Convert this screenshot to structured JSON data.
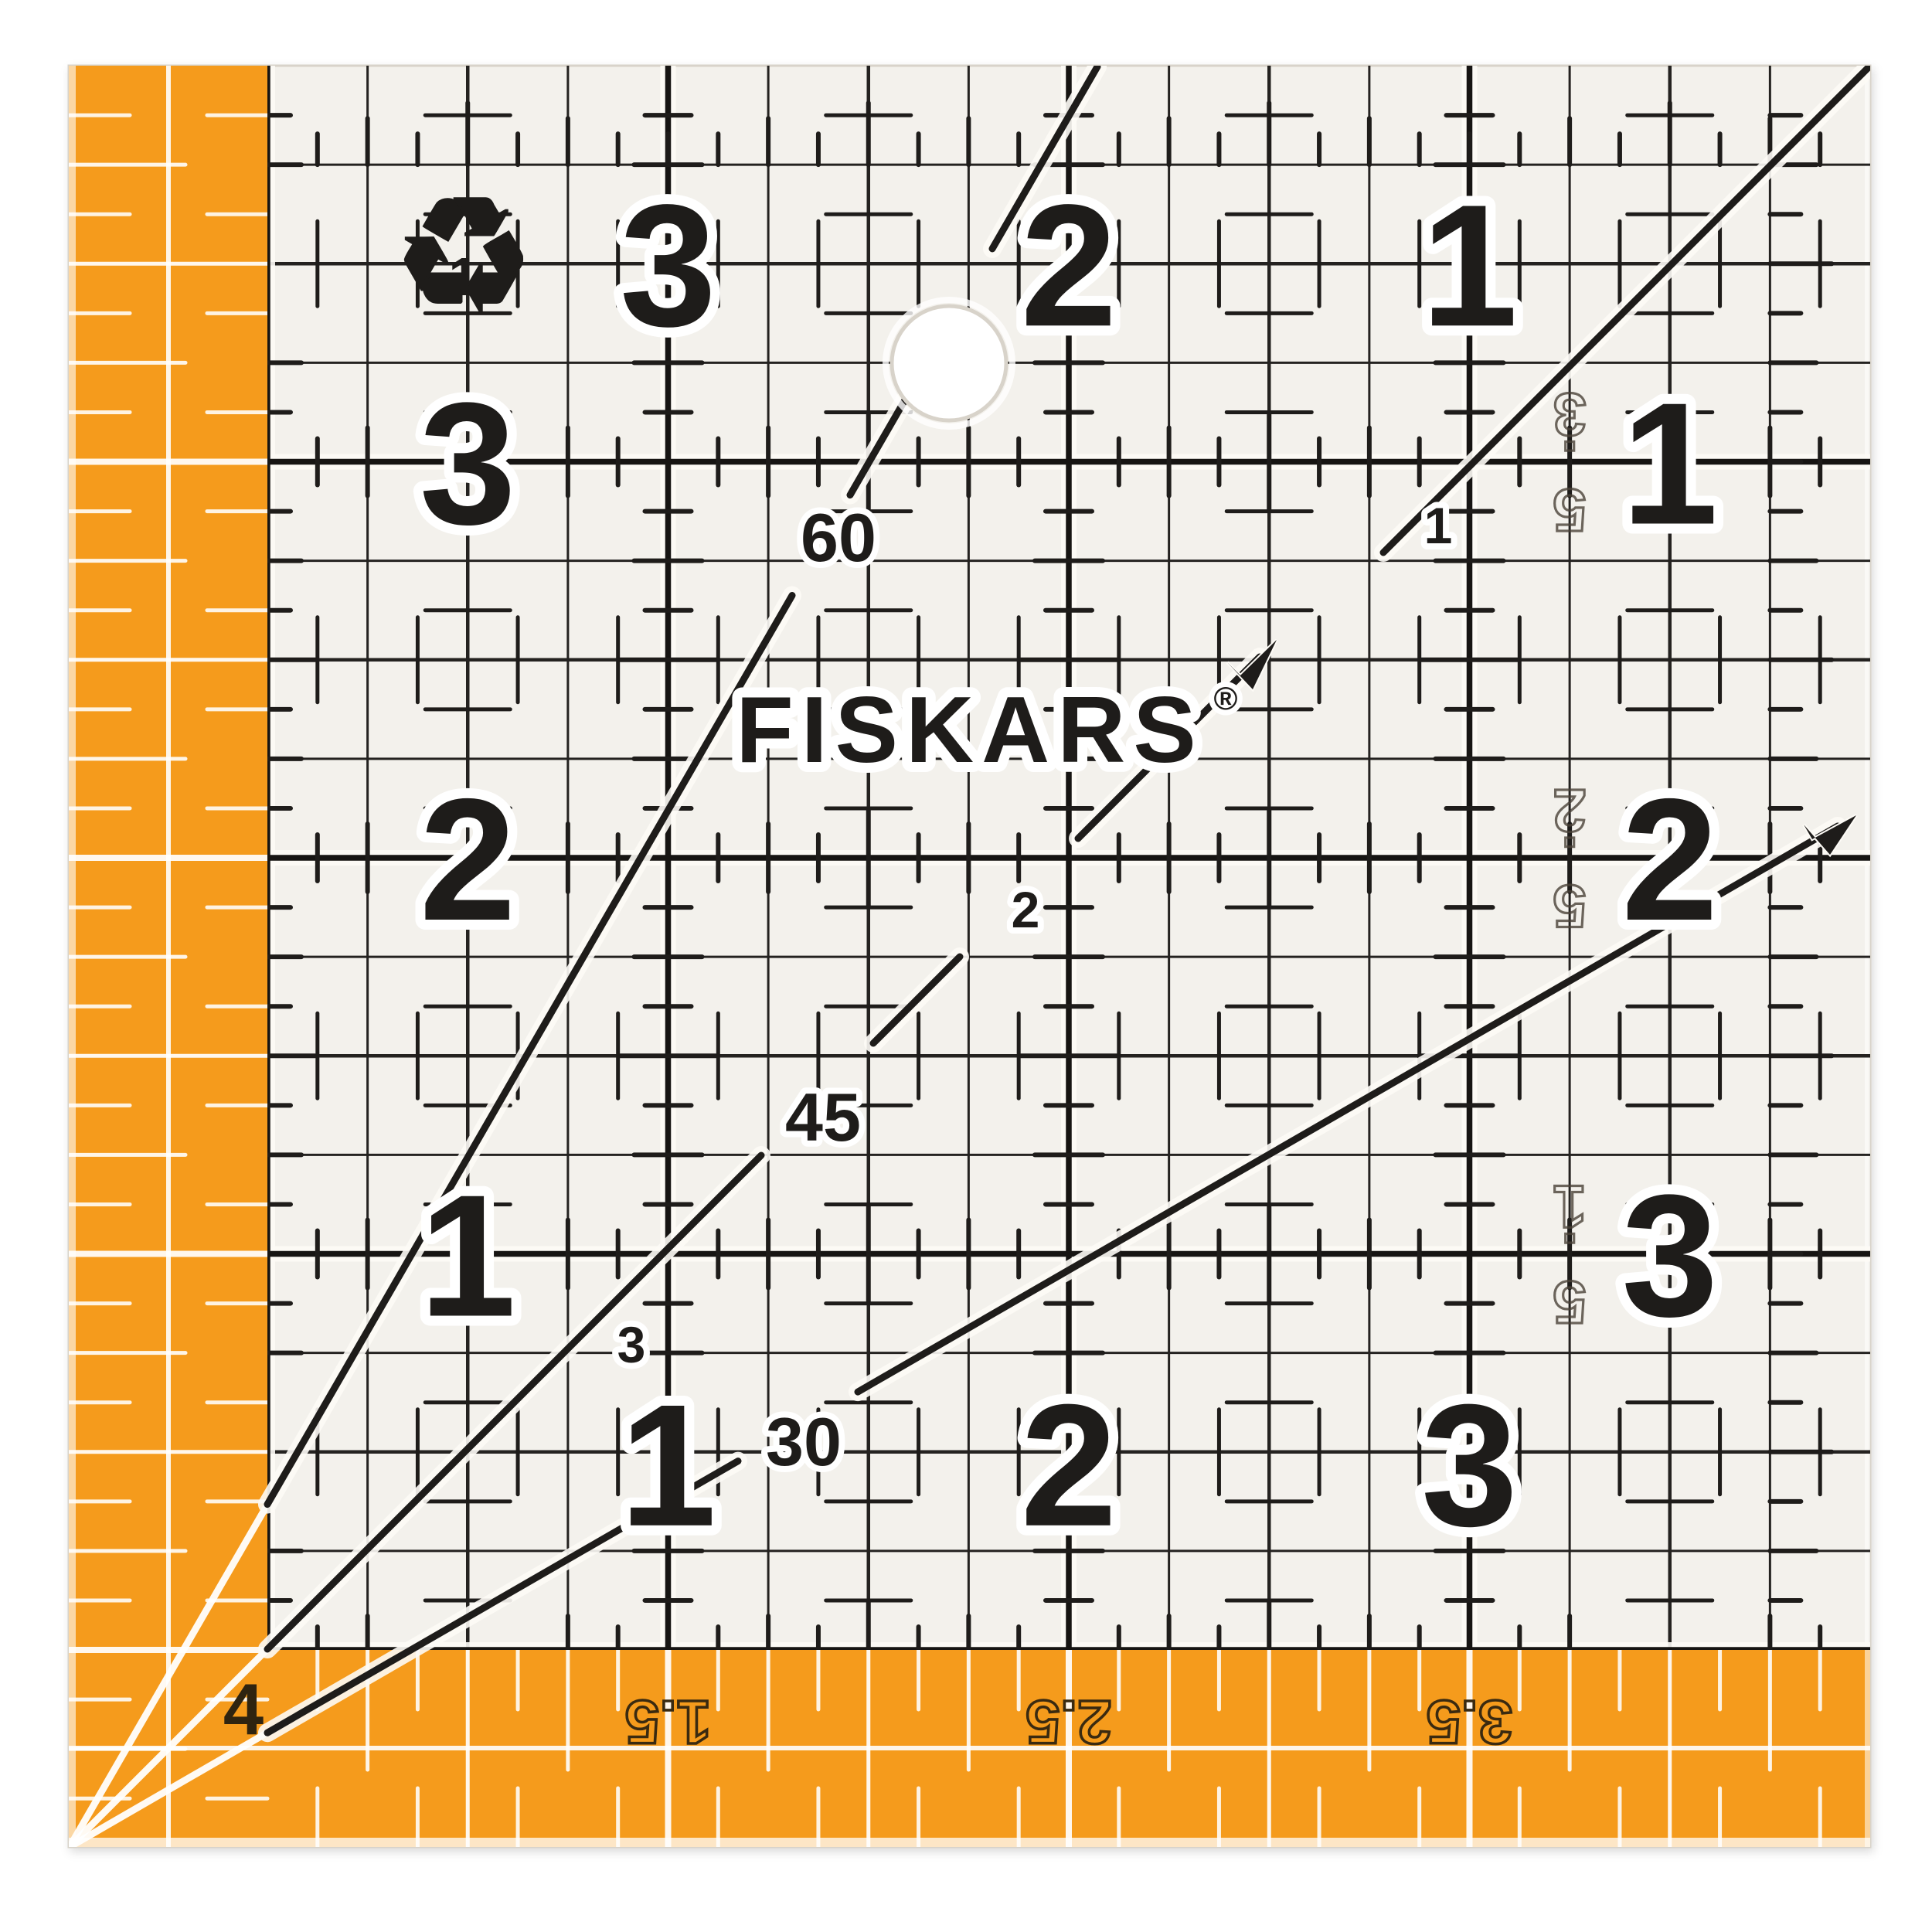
{
  "product": {
    "brand": "FISKARS",
    "registered": "®"
  },
  "colors": {
    "orange": "#F59B1C",
    "orange_deep": "#ED8F0E",
    "print_black": "#1e1c1a",
    "acrylic": "#f3f1ec",
    "halo_white": "#fdfbf6",
    "gray_label": "#4a4238",
    "strip_label_dark": "#3a2a10",
    "white_marking": "#ffffff"
  },
  "grid": {
    "top_numbers": [
      "3",
      "2",
      "1"
    ],
    "left_numbers": [
      "3",
      "2",
      "1"
    ],
    "right_numbers": [
      "1",
      "2",
      "3"
    ],
    "bottom_numbers": [
      "1",
      "2",
      "3"
    ],
    "half_inch_labels": [
      "3.5",
      "2.5",
      "1.5"
    ],
    "angle_labels": [
      "60",
      "45",
      "30"
    ],
    "diagonal_point_labels": [
      "1",
      "2",
      "3"
    ]
  },
  "orange_strip": {
    "corner_label": "4",
    "bottom_labels": [
      "1.5",
      "2.5",
      "3.5"
    ]
  },
  "icons": {
    "recycling_symbol": "♻",
    "recycling_code": "1",
    "hole": "hanging-hole"
  }
}
